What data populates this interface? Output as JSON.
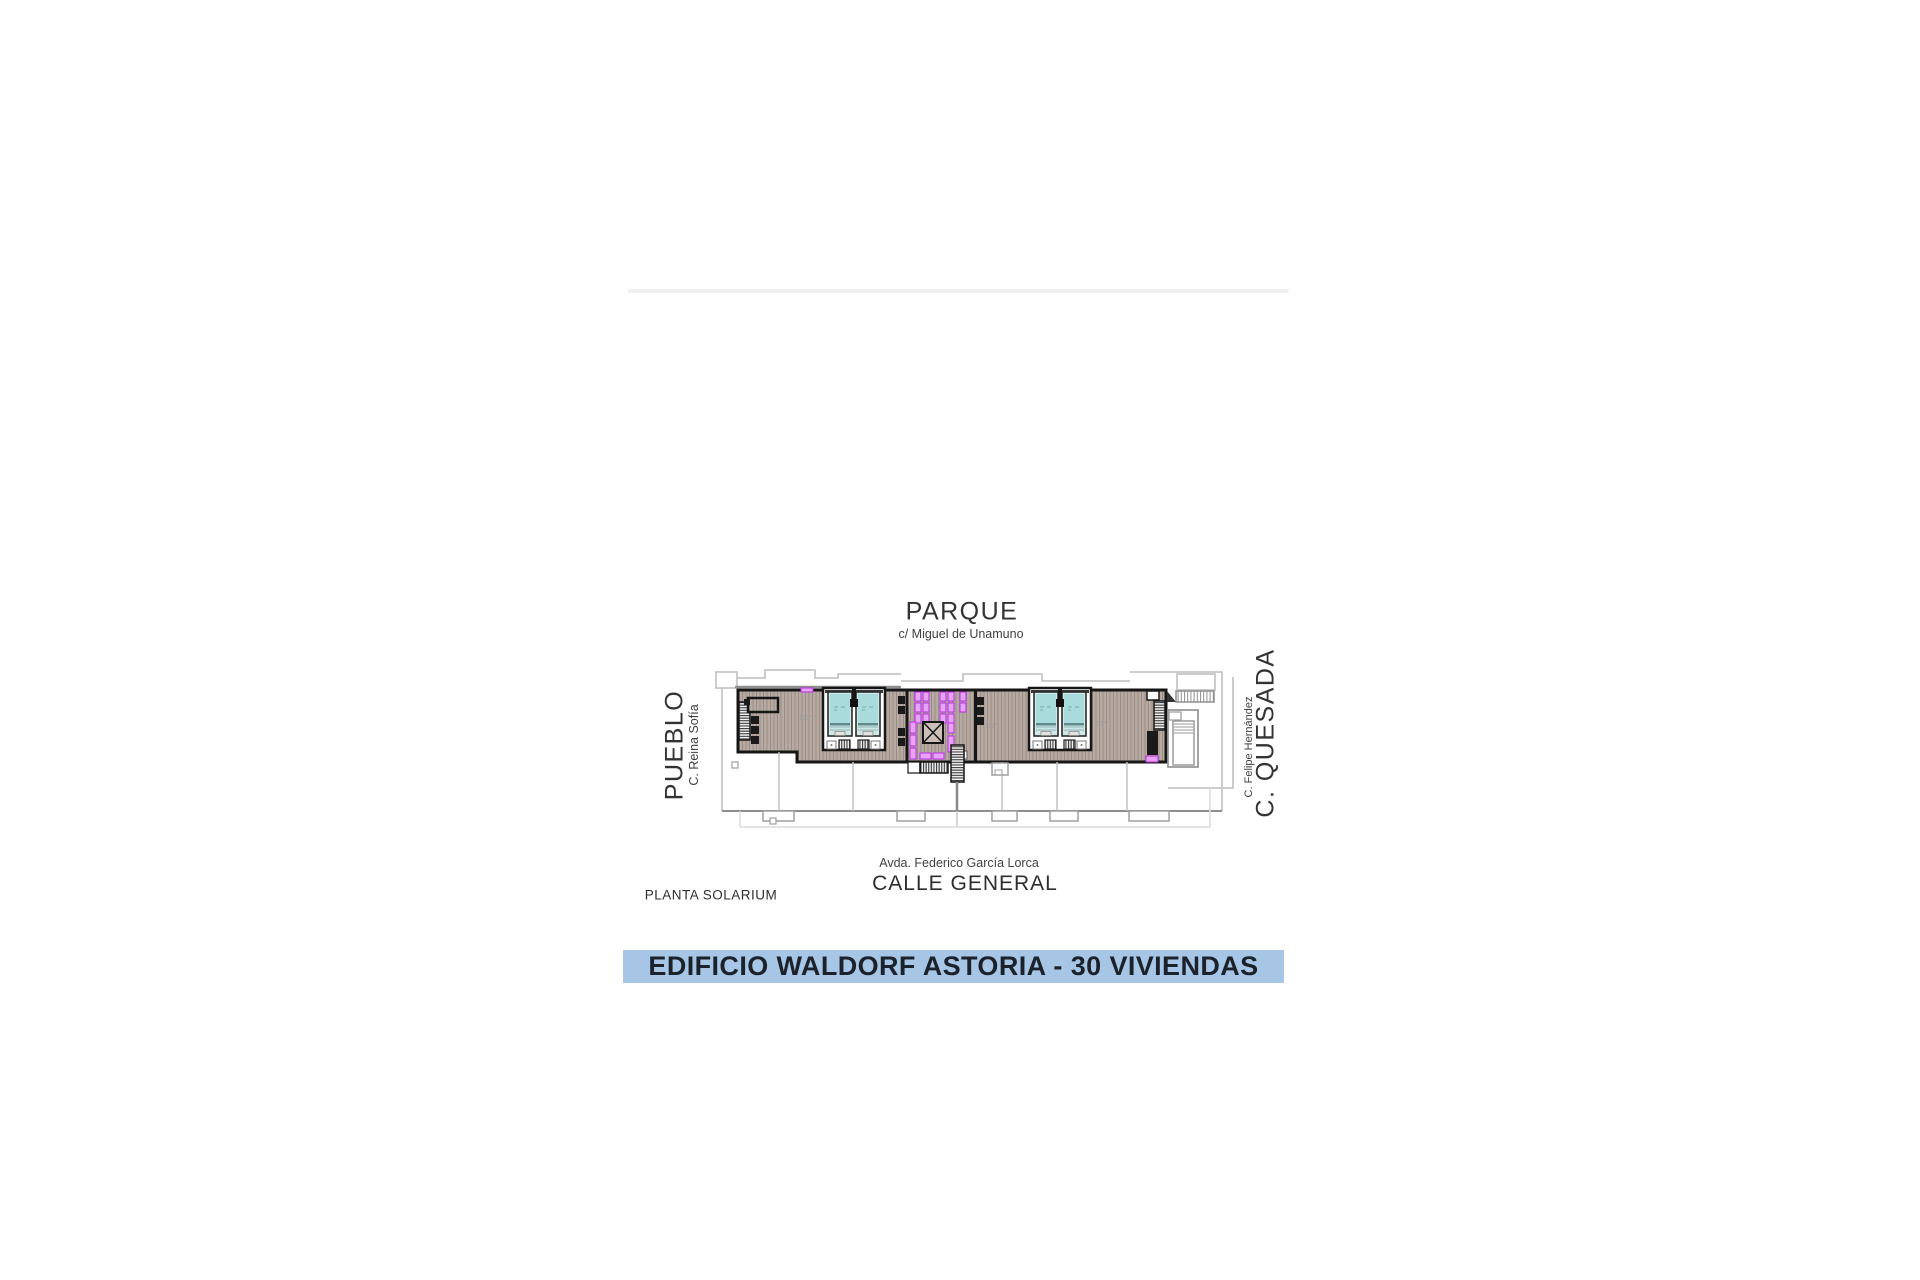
{
  "page": {
    "background": "#ffffff"
  },
  "plan": {
    "name_label": "PLANTA SOLARIUM",
    "areas": {
      "top": {
        "name": "PARQUE",
        "street": "c/ Miguel de Unamuno"
      },
      "left": {
        "name": "PUEBLO",
        "street": "C. Reina Sofía"
      },
      "right": {
        "name": "C. QUESADA",
        "street": "C. Felipe Hernández"
      },
      "bottom": {
        "name": "CALLE GENERAL",
        "street": "Avda. Federico García Lorca"
      }
    },
    "colors": {
      "deck": "#b7aaa2",
      "deck_hatch": "#9a8d85",
      "pool_water": "#a9dadc",
      "pool_surround": "#cfe7e7",
      "lounger_fill": "#e7a3f6",
      "lounger_stroke": "#bb2ee8",
      "wall": "#161616",
      "outline_light": "#c6c6c6",
      "outline_medium": "#8f8f8f"
    }
  },
  "banner": {
    "title": "EDIFICIO WALDORF ASTORIA - 30 VIVIENDAS",
    "background": "#a7c6e5",
    "text_color": "#1c222b"
  }
}
